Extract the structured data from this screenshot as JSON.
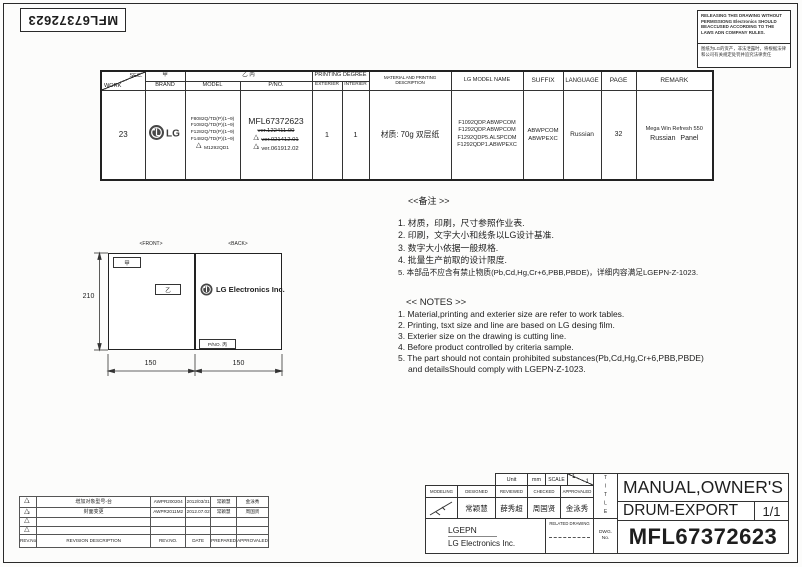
{
  "sheet": {
    "doc_number_rotated": "MFL67372623",
    "warning_en": "RELEASING THIS DRAWING WITHOUT PERMISSIONG Electronics SHOULD BEACCUSED ACCORDING TO THE LAWS ADN COMPANY RULES.",
    "warning_cn": "图纸为LG的资产，非法泄露时，将根据法律和公司有关规定处罚并追究法律责任"
  },
  "work_table": {
    "headers": {
      "sec": "SEC.",
      "work": "WORK",
      "jia": "甲",
      "brand": "BRAND",
      "yi_bing": "乙 丙",
      "model": "MODEL",
      "pno": "P/NO.",
      "printing_degree": "PRINTING DEGREE",
      "exterier": "EXTERIER",
      "interier": "INTERIER",
      "material": "MATERIAL AND PRINTING DESCRIPTION",
      "lg_model_name": "LG MODEL NAME",
      "suffix": "SUFFIX",
      "language": "LANGUAGE",
      "page": "PAGE",
      "remark": "REMARK"
    },
    "row": {
      "work": "23",
      "brand": "LG",
      "models": [
        "F8082Q/TD(P)(1~9)",
        "F1082Q/TD(P)(1~9)",
        "F1282Q/TD(P)(1~9)",
        "F1482Q/TD(P)(1~9)",
        "M1292QD1"
      ],
      "model_delta": "1",
      "pno_main": "MFL67372623",
      "versions": [
        {
          "text": "ver.122411.00"
        },
        {
          "text": "ver.021412.01",
          "delta": "1"
        },
        {
          "text": "ver.061912.02",
          "delta": "2"
        }
      ],
      "exterier": "1",
      "interier": "1",
      "material": "材质: 70g 双层纸",
      "lg_models": [
        "F1092QDP.ABWPCOM",
        "F1292QDP.ABWPCOM",
        "F1292QDP5.ALSPCOM",
        "F1292QDP1.ABWPEXC"
      ],
      "suffixes": [
        "ABWPCOM",
        "ABWPEXC"
      ],
      "language": "Russian",
      "page": "32",
      "remark": [
        "Mega Win Refresh 550",
        "Russian  Panel"
      ]
    }
  },
  "drawing": {
    "front": "<FRONT>",
    "back": "<BACK>",
    "jia": "甲",
    "yi": "乙",
    "logo": "LG Electronics Inc.",
    "pno_box": "P/NO. 丙",
    "dim_height": "210",
    "dim_width_left": "150",
    "dim_width_right": "150"
  },
  "notes_cn": {
    "title": "<<备注 >>",
    "items": [
      "1.  材质，印刷，尺寸参照作业表.",
      "2.  印刷，文字大小和线条以LG设计基准.",
      "3.  数字大小依据一般规格.",
      "4.  批量生产前取的设计限度.",
      "5.  本部品不应含有禁止物质(Pb,Cd,Hg,Cr+6,PBB,PBDE)，详细内容满足LGEPN-Z-1023."
    ]
  },
  "notes_en": {
    "title": "<< NOTES >>",
    "items": [
      "1. Material,printing and exterier size are refer to work tables.",
      "2. Printing, tsxt  size and line are based on LG desing film.",
      "3. Exterier size on the drawing is cutting line.",
      "4. Before product controlled by criteria sample.",
      "5. The part should not contain prohibited substances(Pb,Cd,Hg,Cr+6,PBB,PBDE)",
      "and detailsShould comply with LGEPN-Z-1023."
    ]
  },
  "revision": {
    "rows": [
      {
        "no": "1",
        "desc": "增加对象型号-台",
        "rev_no": "AWPR200204",
        "date": "2012/03/31",
        "prepared": "常颖慧",
        "approved": "金泳秀"
      },
      {
        "no": "2",
        "desc": "封面变更",
        "rev_no": "AWPR2011M2",
        "date": "2012.07.02",
        "prepared": "常颖慧",
        "approved": "周国贤"
      },
      {
        "no": "",
        "desc": "",
        "rev_no": "",
        "date": "",
        "prepared": "",
        "approved": ""
      },
      {
        "no": "",
        "desc": "",
        "rev_no": "",
        "date": "",
        "prepared": "",
        "approved": ""
      }
    ],
    "labels": {
      "rev_col": "REV.No",
      "desc": "REVISION DESCRIPTION",
      "rev_no": "REV.NO.",
      "date": "DATE",
      "prepared": "PREPARED",
      "approved": "APPROVALED"
    }
  },
  "title_block": {
    "unit_label": "Unit",
    "unit_value": "mm",
    "scale_label": "SCALE",
    "scale_num": "1",
    "scale_den": "1",
    "modeling": "MODELING",
    "designed": "DESIGNED",
    "reviewed": "REVIEWED",
    "checked": "CHECKED",
    "approvaled": "APPROVALED",
    "designed_name": "常颖慧",
    "reviewed_name": "薛秀超",
    "checked_name": "周国贤",
    "approved_name": "金泳秀",
    "company_short": "LGEPN",
    "company": "LG Electronics Inc.",
    "related_drawing": "RELATED DRAWING",
    "dwg": "DWG.",
    "no": "No.",
    "title_vertical": "TITLE",
    "title_line1": "MANUAL,OWNER'S",
    "title_line2": "DRUM-EXPORT",
    "sheet": "1/1",
    "drawing_number": "MFL67372623"
  }
}
